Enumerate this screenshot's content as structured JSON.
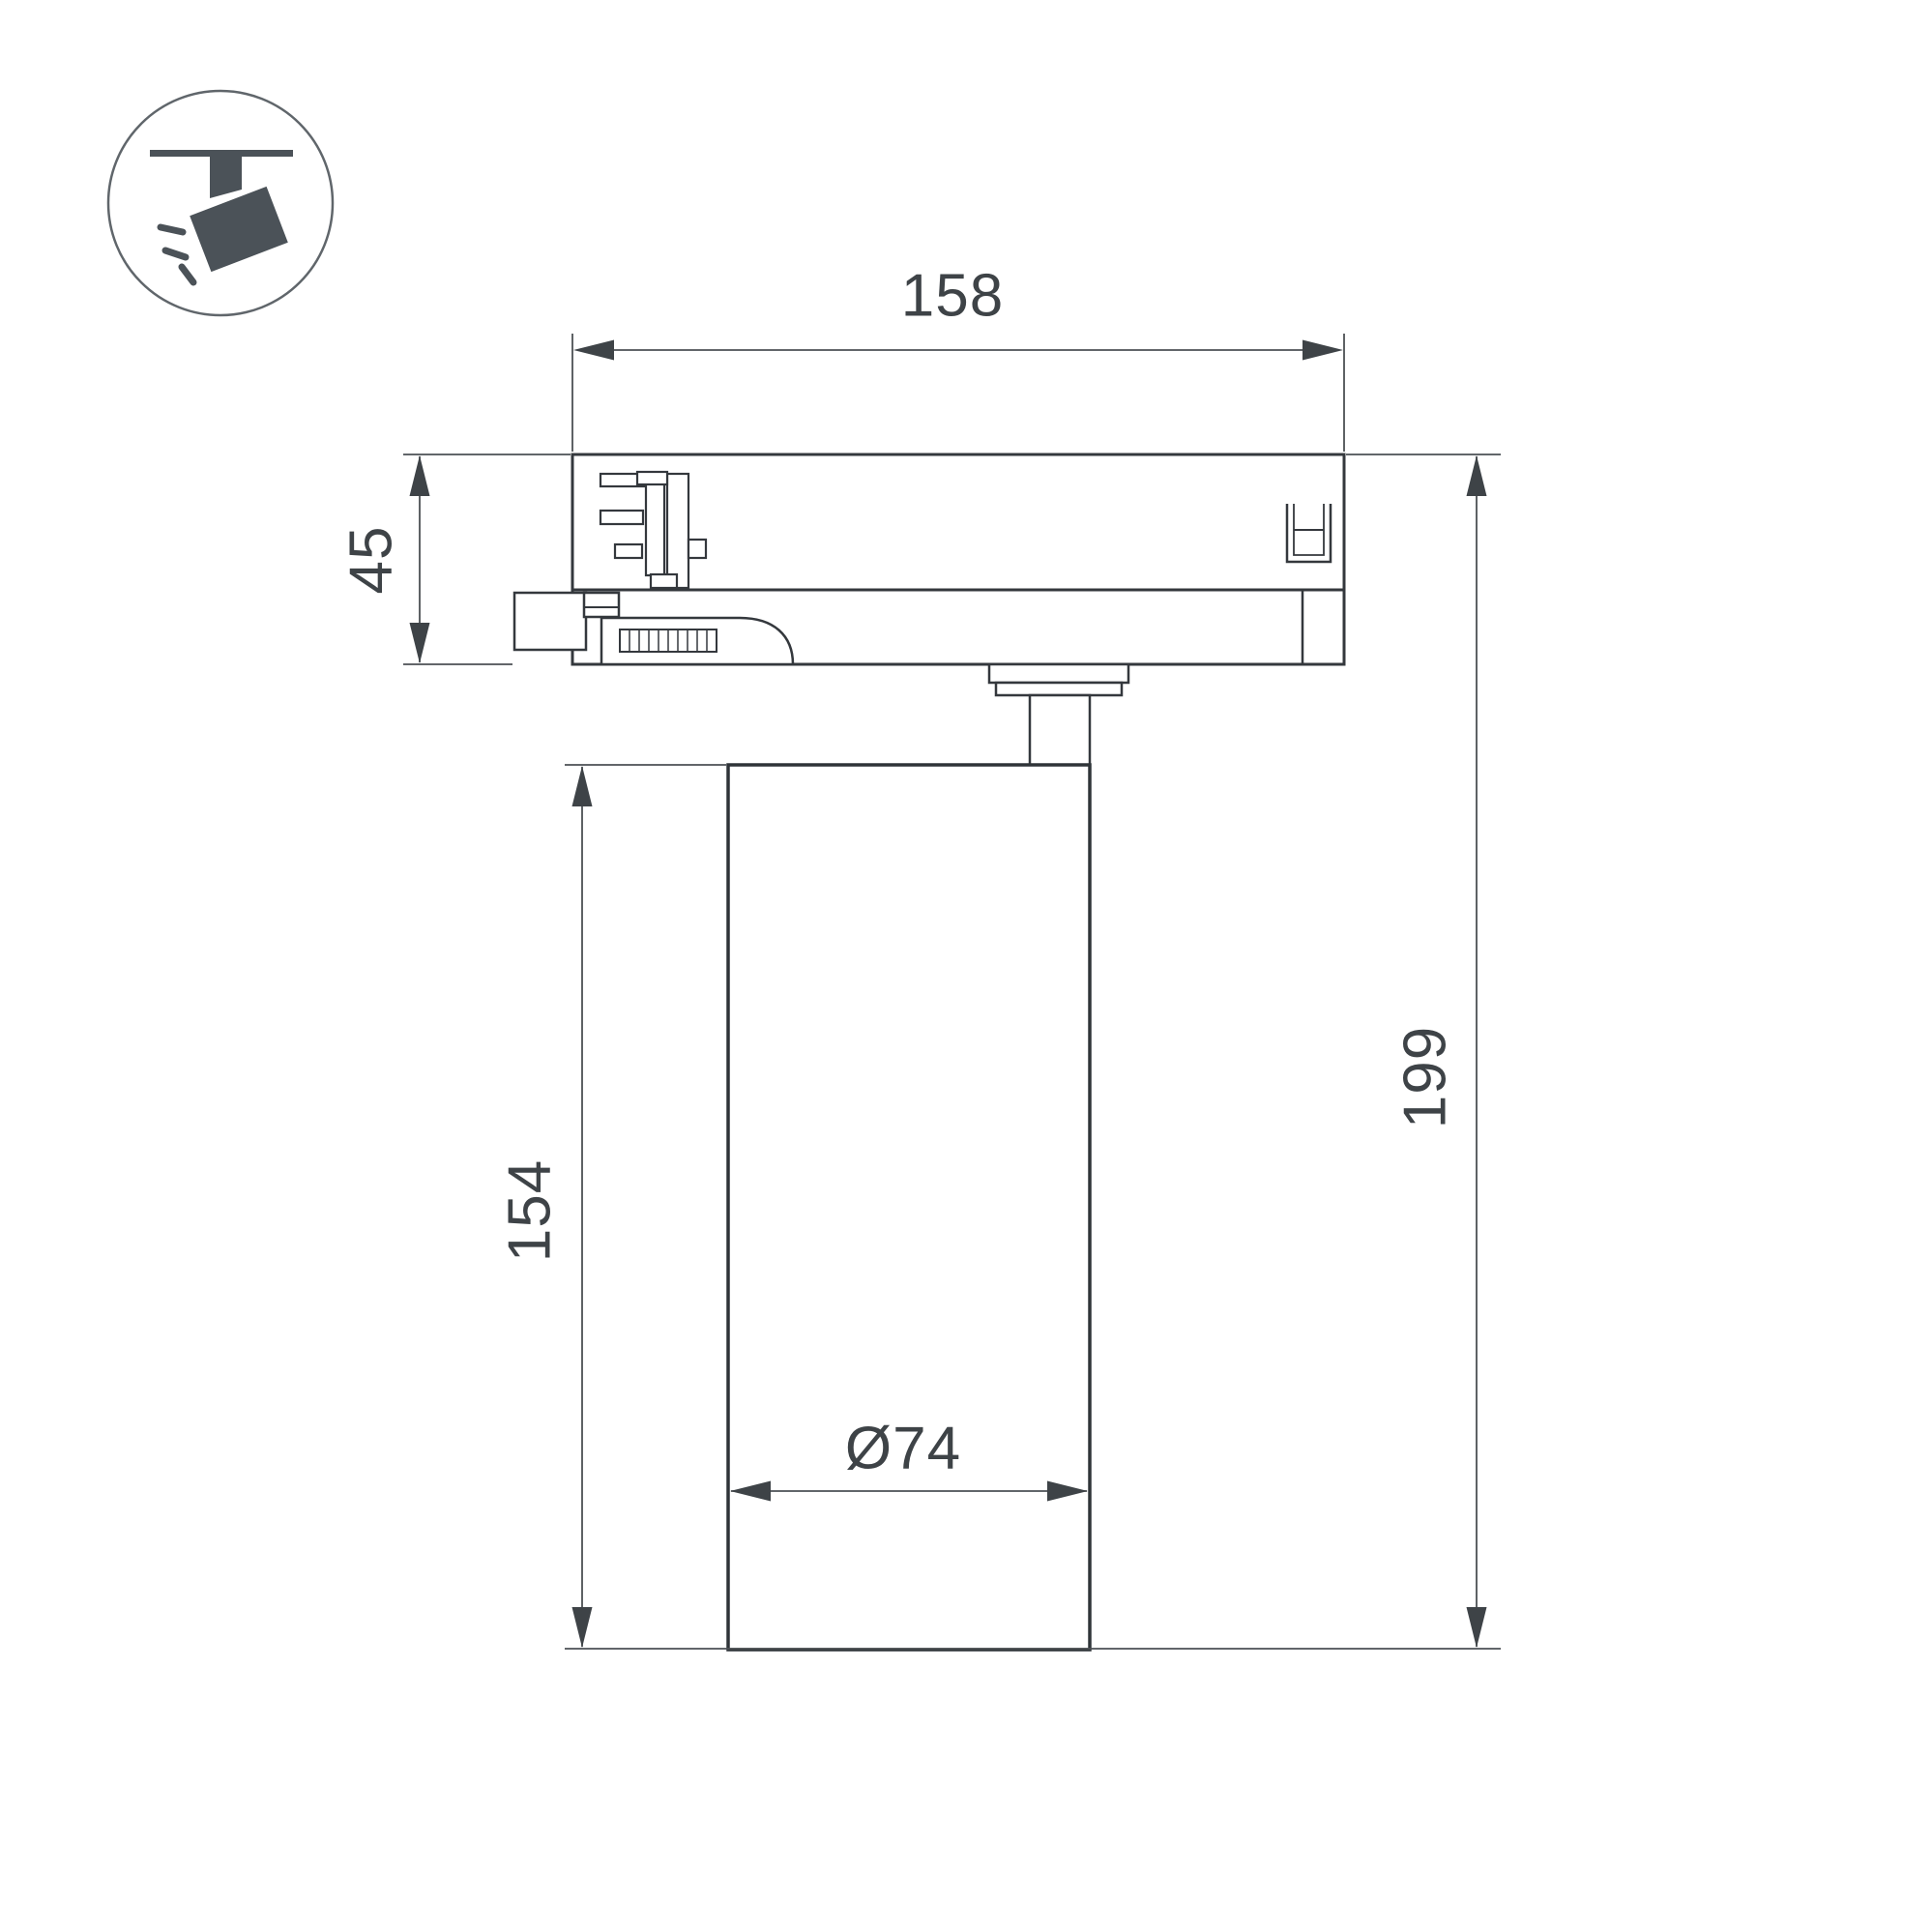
{
  "page": {
    "type": "technical-dimension-drawing",
    "subject": "track-light-fixture-side-view",
    "background": "#ffffff"
  },
  "legend": {
    "icon": "track-spotlight-icon"
  },
  "dimensions": {
    "top_width": "158",
    "adapter_height": "45",
    "body_height": "154",
    "total_height": "199",
    "diameter": "Ø74"
  },
  "colors": {
    "outline": "#34383d",
    "dimension_line": "#4c5054",
    "arrow_fill": "#3e4347",
    "text": "#3e4347",
    "icon_fill": "#4b5258",
    "icon_circle_stroke": "#60666b"
  }
}
